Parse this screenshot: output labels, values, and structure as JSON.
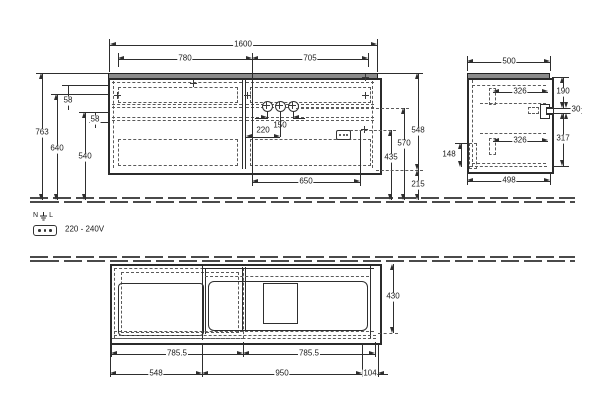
{
  "front": {
    "w1600": "1600",
    "w780": "780",
    "w705": "705",
    "h763": "763",
    "h640": "640",
    "h540": "540",
    "h58": "58",
    "w150": "150",
    "w220": "220",
    "w650": "650",
    "h548": "548",
    "h570": "570",
    "h435": "435",
    "h215": "215"
  },
  "side": {
    "w500": "500",
    "w498": "498",
    "w326": "326",
    "h190": "190",
    "h30": "30",
    "h317": "317",
    "h148": "148"
  },
  "plan": {
    "w785": "785.5",
    "w548": "548",
    "w950": "950",
    "w104": "104",
    "d430": "430"
  },
  "electrical": {
    "n": "N",
    "l": "L",
    "voltage": "220 - 240V"
  }
}
